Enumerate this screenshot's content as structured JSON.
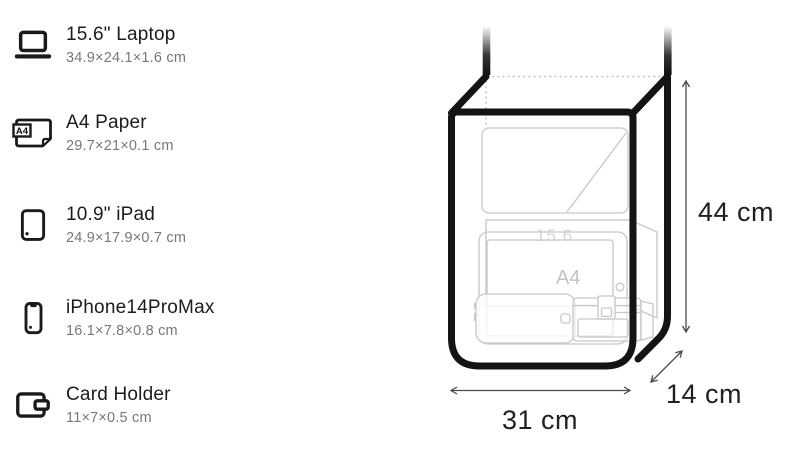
{
  "items": [
    {
      "icon": "laptop-icon",
      "name": "15.6\" Laptop",
      "dims": "34.9×24.1×1.6 cm"
    },
    {
      "icon": "a4-paper-icon",
      "name": "A4 Paper",
      "dims": "29.7×21×0.1 cm",
      "icon_label": "A4"
    },
    {
      "icon": "ipad-icon",
      "name": "10.9\" iPad",
      "dims": "24.9×17.9×0.7 cm"
    },
    {
      "icon": "iphone-icon",
      "name": "iPhone14ProMax",
      "dims": "16.1×7.8×0.8 cm"
    },
    {
      "icon": "card-holder-icon",
      "name": "Card Holder",
      "dims": "11×7×0.5 cm"
    }
  ],
  "diagram": {
    "height_label": "44 cm",
    "width_label": "31 cm",
    "depth_label": "14 cm",
    "ghost_laptop_label": "15.6",
    "ghost_a4_label": "A4",
    "colors": {
      "bag_outline": "#141414",
      "ghost_outline": "#c7c7cc",
      "dimension_lines": "#4a4a4a",
      "label_text": "#202022",
      "subtitle_text": "#77777c"
    }
  }
}
